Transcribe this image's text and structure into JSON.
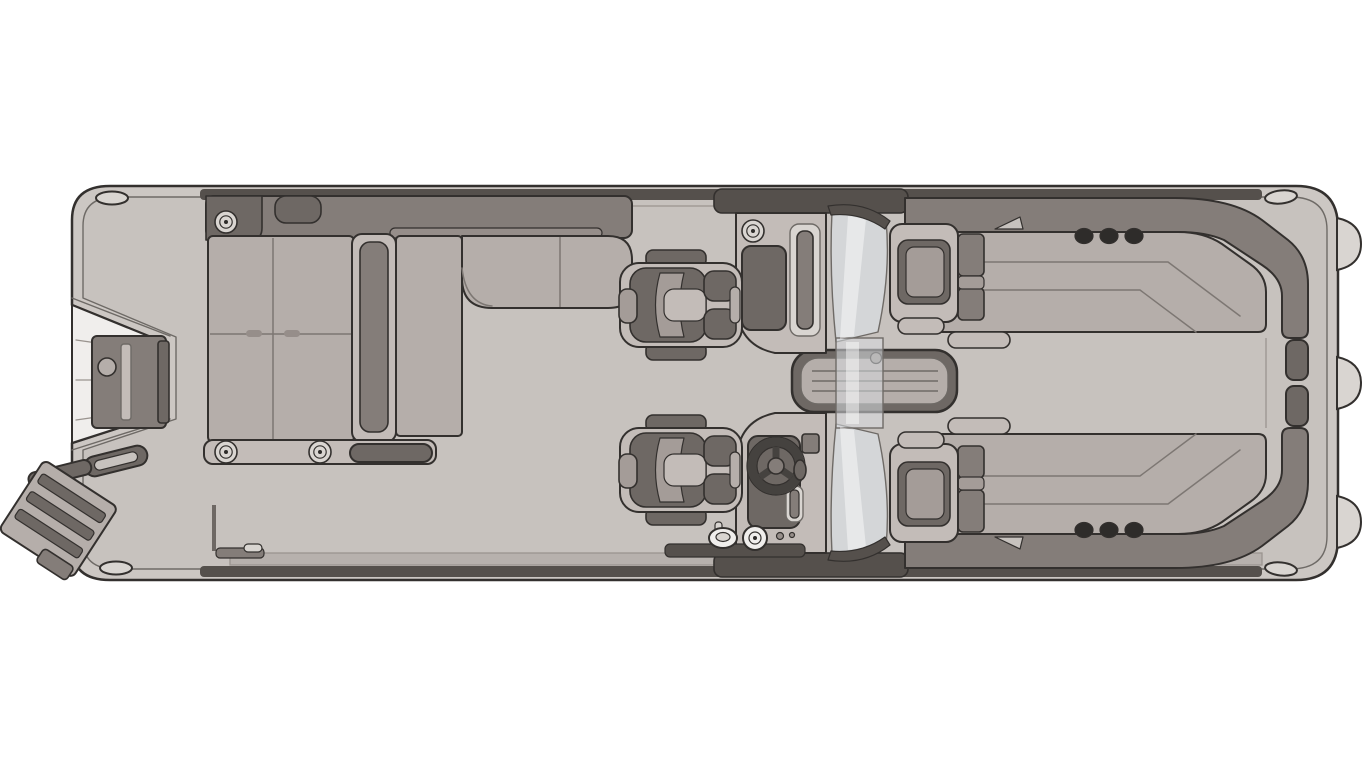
{
  "scene": {
    "kind": "pontoon-boat-floor-plan",
    "view": "overhead top-down line rendering",
    "background": "#ffffff",
    "orientation": {
      "bow": "right",
      "stern": "left"
    }
  },
  "palette": {
    "outline": "#33302e",
    "rim": "#ccc7c3",
    "deck": "#c7c2be",
    "strip": "#55504c",
    "faceLight": "#b7b1ad",
    "backrest": "#847d79",
    "trimdark": "#6e6864",
    "cushion": "#b5aeaa",
    "cushionMid": "#a49c98",
    "cushionDeep": "#968e8a",
    "shell": "#c3bcb8",
    "whiteDetail": "#f0eeec",
    "glass": "#d7dade",
    "dark": "#2e2c2a",
    "lightGray": "#d9d5d1",
    "bg": "#ffffff"
  },
  "features": {
    "stern": {
      "gate": "stern walk-through gate with latch",
      "platform_step_lines": 3,
      "grab_handle": true,
      "boarding_ladder_rungs": 3
    },
    "aft_lounge": {
      "sun_pad_cushions": 4,
      "chaise_backrest": true,
      "l_bench_sections": 2,
      "flush_speakers": 3,
      "grab_handle": true,
      "side_rail": true
    },
    "helm_area": {
      "captain_chairs": 2,
      "port_console": {
        "glovebox": true,
        "speaker": true,
        "grab_slot": true
      },
      "helm_console": {
        "steering_wheel": true,
        "display": true,
        "grab_slot": true
      },
      "walkthrough_windshield": true,
      "floor_hatch": {
        "slats": 3,
        "latch": true
      },
      "ski_pylon_cap": true,
      "latch_plate_grommet": true
    },
    "bow_lounges": {
      "count": 2,
      "cup_holders_each": 3,
      "armrest_pockets": 2,
      "corner_trim_caps": 2
    },
    "hull": {
      "cleats": 4,
      "pontoon_noses": 3,
      "rub_rail": "double line"
    }
  }
}
